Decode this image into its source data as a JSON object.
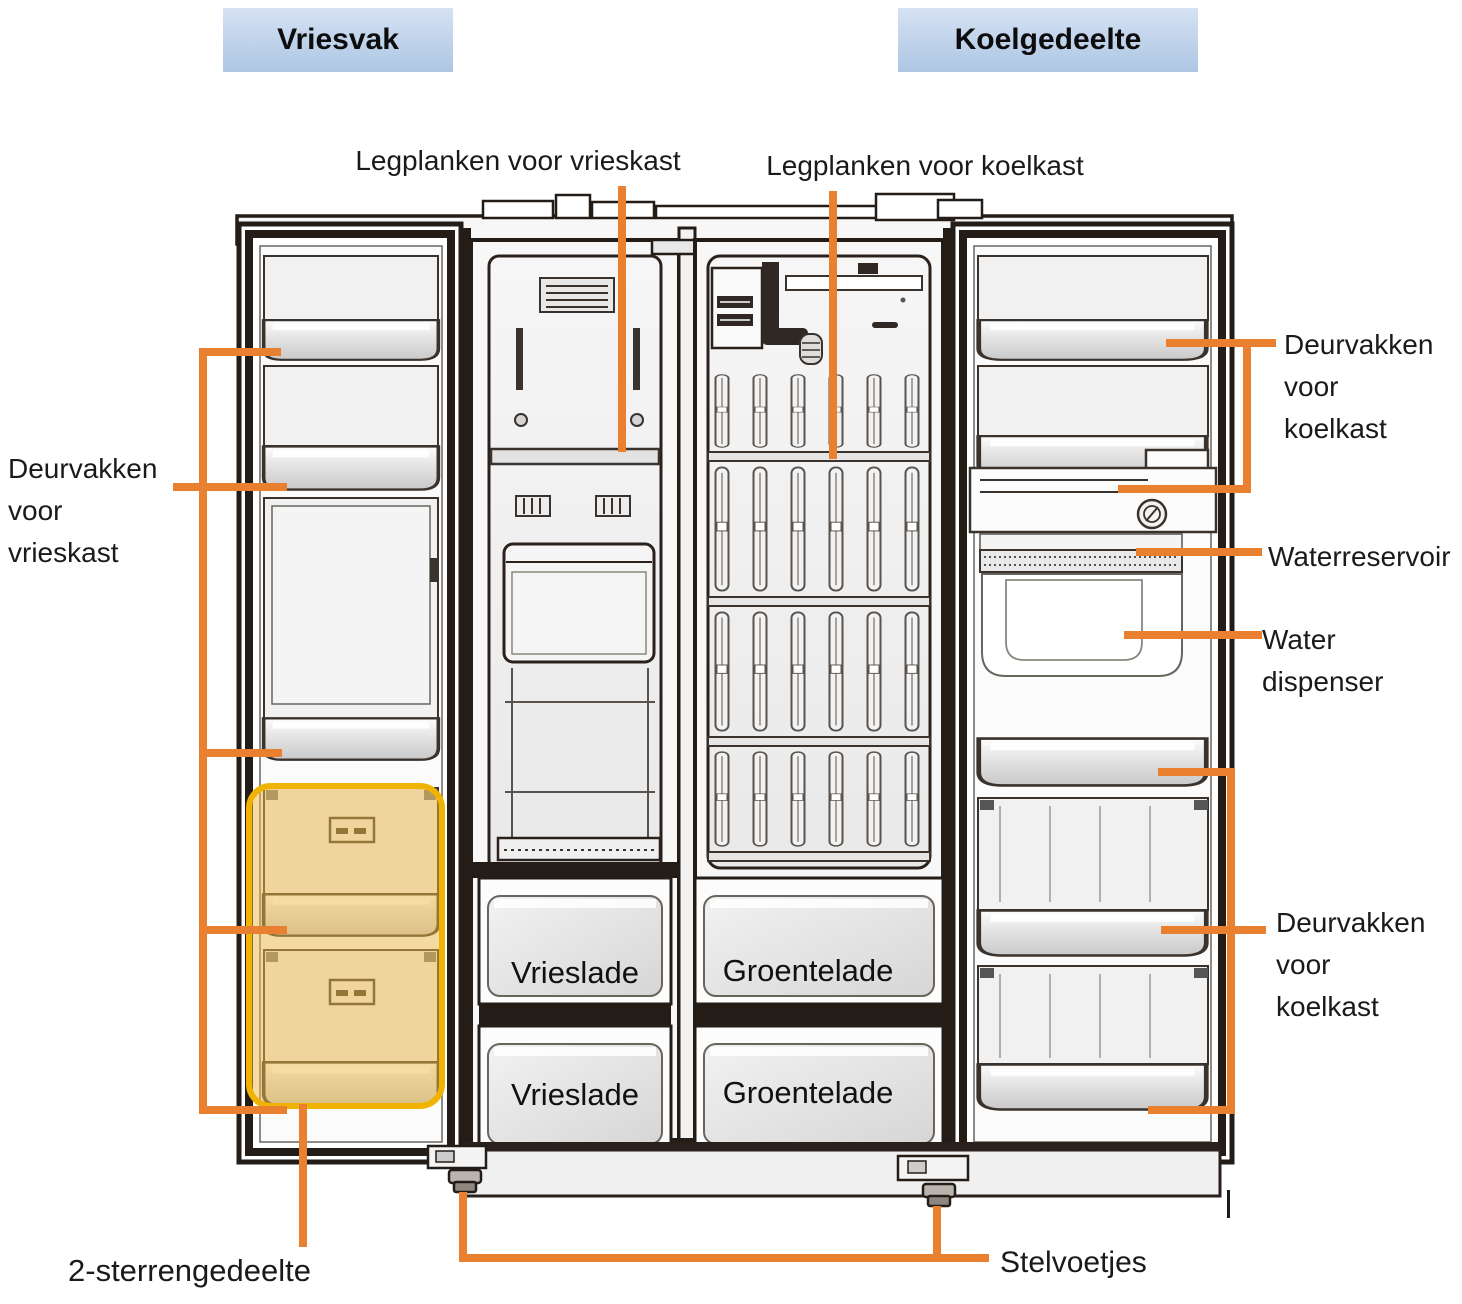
{
  "colors": {
    "leader_orange": "#E8802F",
    "header_gradient_top": "#D6E2F3",
    "header_gradient_bottom": "#AEC6E2",
    "highlight_border": "#F0B303",
    "highlight_fill": "#EDBA45",
    "outline_black": "#2A211C"
  },
  "headers": {
    "freezer": "Vriesvak",
    "fridge": "Koelgedeelte"
  },
  "annotations": {
    "freezer_shelves": "Legplanken voor vrieskast",
    "fridge_shelves": "Legplanken voor koelkast",
    "freezer_door_bins": "Deurvakken\nvoor\nvrieskast",
    "fridge_door_bins_top": "Deurvakken\nvoor\nkoelkast",
    "water_reservoir": "Waterreservoir",
    "water_dispenser": "Water dispenser",
    "fridge_door_bins_bottom": "Deurvakken\nvoor\nkoelkast",
    "two_star_section": "2-sterrengedeelte",
    "leveling_feet": "Stelvoetjes"
  },
  "compartment_labels": {
    "freezer_drawer_top": "Vrieslade",
    "freezer_drawer_bottom": "Vrieslade",
    "crisper_drawer_top": "Groentelade",
    "crisper_drawer_bottom": "Groentelade"
  }
}
